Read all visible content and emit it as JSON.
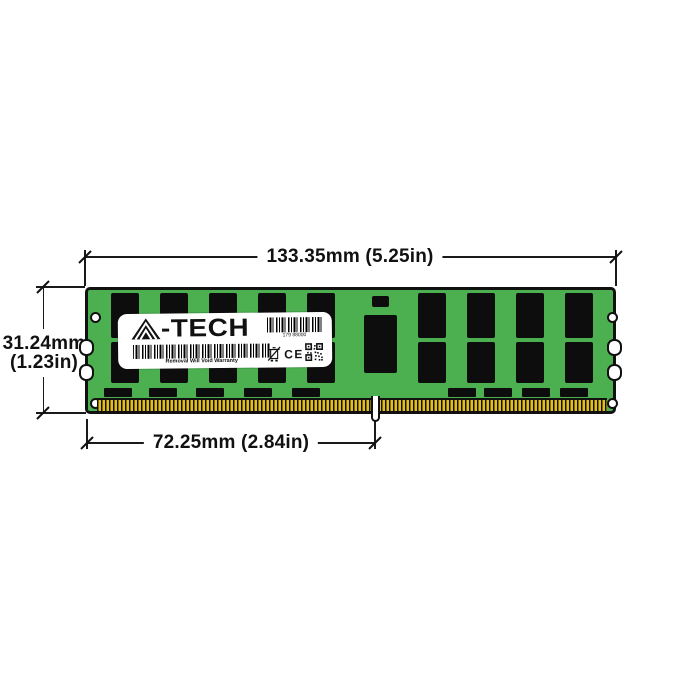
{
  "annotations": {
    "width_label": "133.35mm (5.25in)",
    "height_label": [
      "31.24mm",
      "(1.23in)"
    ],
    "notch_label": "72.25mm (2.84in)"
  },
  "sticker": {
    "brand": "A-TECH",
    "brand_display": {
      "initial": "A",
      "rest": "-TECH"
    },
    "serial": "179 88000",
    "warranty": "Removal Will Void Warranty",
    "ce": "CE"
  },
  "module": {
    "pcb_color": "#4CB050",
    "chip_color": "#0D0D0D",
    "pin_color": "#E2BE17",
    "outline_color": "#111111",
    "memory_chip_columns": 9,
    "mounting_holes": 4,
    "side_notches": 4
  }
}
